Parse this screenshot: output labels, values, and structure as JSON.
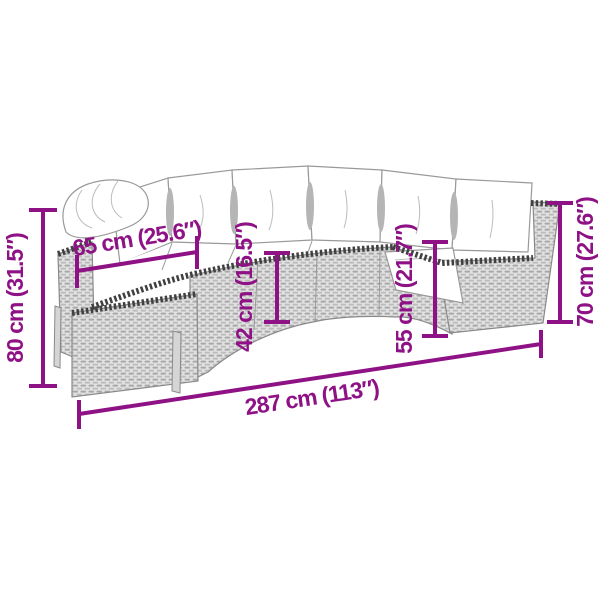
{
  "diagram": {
    "dimensions": {
      "left_height": {
        "label": "80 cm (31.5″)"
      },
      "top_width": {
        "label": "65 cm (25.6″)"
      },
      "mid_left_height": {
        "label": "42 cm (16.5″)"
      },
      "mid_right_height": {
        "label": "55 cm (21.7″)"
      },
      "right_height": {
        "label": "70 cm (27.6″)"
      },
      "bottom_width": {
        "label": "287 cm (113″)"
      }
    },
    "colors": {
      "dimension": "#8E1285",
      "rattan_light": "#E2E2E2",
      "rattan_dark": "#A8A8A8",
      "trim": "#404040",
      "outline": "#8A8A8A",
      "background": "#FFFFFF"
    }
  }
}
